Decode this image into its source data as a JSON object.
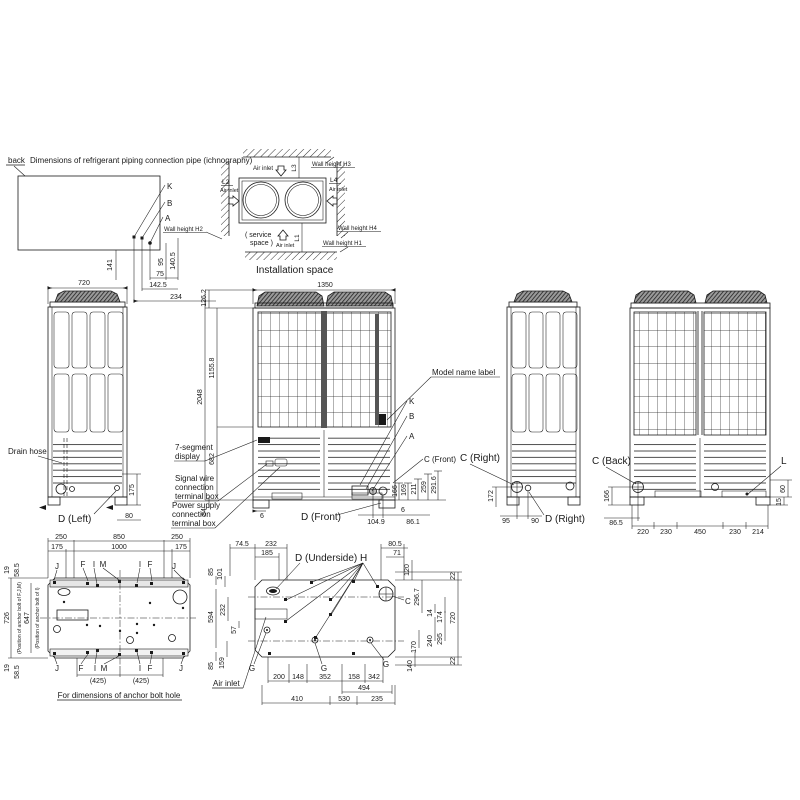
{
  "colors": {
    "line": "#1a1a1a",
    "background": "#ffffff",
    "fan_hatch": "#555555"
  },
  "piping": {
    "back": "back",
    "title": "Dimensions of refrigerant piping connection pipe (ichnography)",
    "k": "K",
    "b": "B",
    "a": "A",
    "dims": [
      "141",
      "95",
      "140.5",
      "75",
      "142.5",
      "234"
    ]
  },
  "install": {
    "air_inlet": "Air inlet",
    "l1": "L1",
    "l2": "L2",
    "l3": "L3",
    "l4": "L4",
    "wh1": "Wall height H1",
    "wh2": "Wall height H2",
    "wh3": "Wall height H3",
    "wh4": "Wall height H4",
    "service": [
      "( service",
      "space )"
    ],
    "caption": "Installation space"
  },
  "left_view": {
    "width": "720",
    "drain": "Drain hose",
    "caption": "D (Left)",
    "dims": [
      "175",
      "80"
    ]
  },
  "front_view": {
    "width": "1350",
    "left_dims": [
      "126.2",
      "1155.8",
      "2048",
      "682",
      "84"
    ],
    "bottom_dims": [
      "6",
      "104.9",
      "6",
      "86.1"
    ],
    "right_dims": [
      "166",
      "169",
      "211",
      "259",
      "291.6"
    ],
    "model_label": "Model name label",
    "k": "K",
    "b": "B",
    "a": "A",
    "c_front": "C (Front)",
    "d_front": "D (Front)",
    "seven_segment": [
      "7-segment",
      "display"
    ],
    "signal": [
      "Signal wire",
      "connection",
      "terminal box"
    ],
    "power": [
      "Power supply",
      "connection",
      "terminal box"
    ]
  },
  "right_view": {
    "c_right": "C (Right)",
    "d_right": "D (Right)",
    "dims": [
      "172",
      "95",
      "90"
    ]
  },
  "back_view": {
    "c_back": "C (Back)",
    "l": "L",
    "left_dims": [
      "166",
      "86.5"
    ],
    "bottom_dims": [
      "220",
      "230",
      "450",
      "230",
      "214"
    ],
    "right_dims": [
      "60",
      "15"
    ]
  },
  "anchor": {
    "top_row1": [
      "250",
      "850",
      "250"
    ],
    "top_row2": [
      "175",
      "1000",
      "175"
    ],
    "letters": [
      "J",
      "F",
      "I",
      "M",
      "I",
      "F",
      "J"
    ],
    "left_top": [
      "19",
      "58.5"
    ],
    "pos_fjm_dim": "726",
    "pos_fjm": "(Position of anchor bolt of F,J,M)",
    "pos_i_dim": "647",
    "pos_i": "(Position of anchor bolt of I)",
    "left_bottom": [
      "19",
      "58.5"
    ],
    "b425": [
      "(425)",
      "(425)"
    ],
    "caption": "For dimensions of anchor bolt hole"
  },
  "underside": {
    "caption": "D (Underside)",
    "h": "H",
    "c": "C",
    "g": "G",
    "air_inlet": "Air inlet",
    "top_dims": [
      "74.5",
      "232",
      "185"
    ],
    "top_right": [
      "80.5",
      "71",
      "120",
      "296.7"
    ],
    "right_dims": [
      "14",
      "174",
      "240",
      "295",
      "170",
      "140"
    ],
    "edge_dims": [
      "22",
      "720",
      "22"
    ],
    "left_dims": [
      "85",
      "101",
      "594",
      "232",
      "57",
      "85",
      "159"
    ],
    "bottom_row1": [
      "200",
      "148",
      "352",
      "158",
      "342"
    ],
    "bottom_row2": [
      "494"
    ],
    "bottom_row3": [
      "410",
      "530",
      "235"
    ]
  }
}
